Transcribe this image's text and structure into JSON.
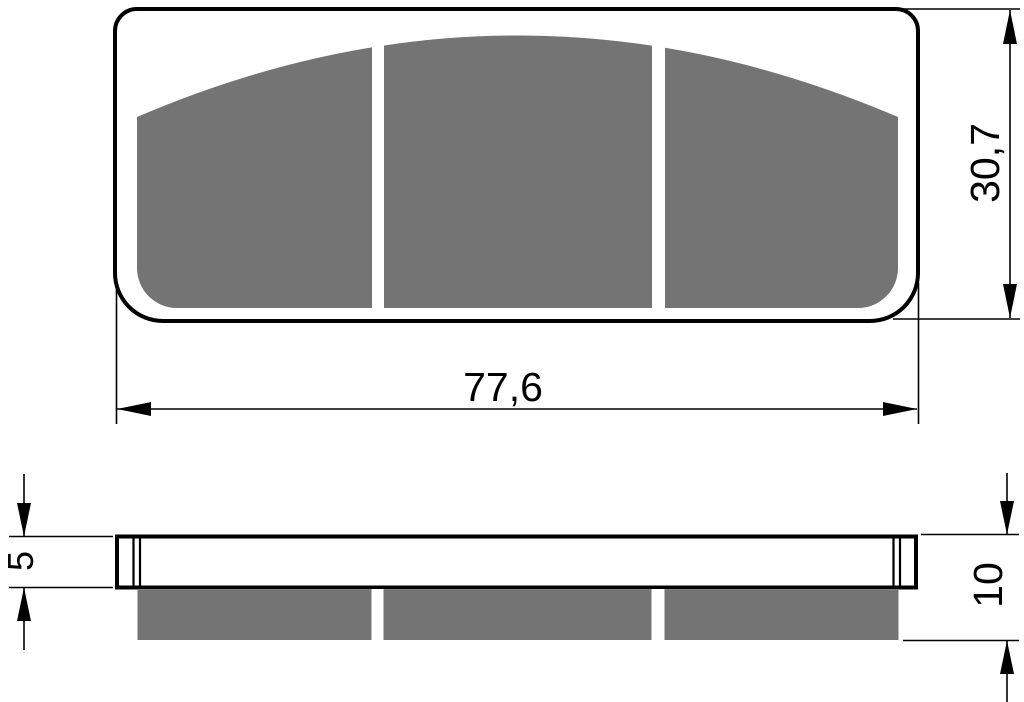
{
  "drawing": {
    "dimensions": {
      "width": "77,6",
      "height": "30,7",
      "backplate_thickness": "5",
      "overall_thickness": "10"
    },
    "colors": {
      "friction_material": "#747474",
      "line": "#000000",
      "background": "#ffffff"
    }
  }
}
